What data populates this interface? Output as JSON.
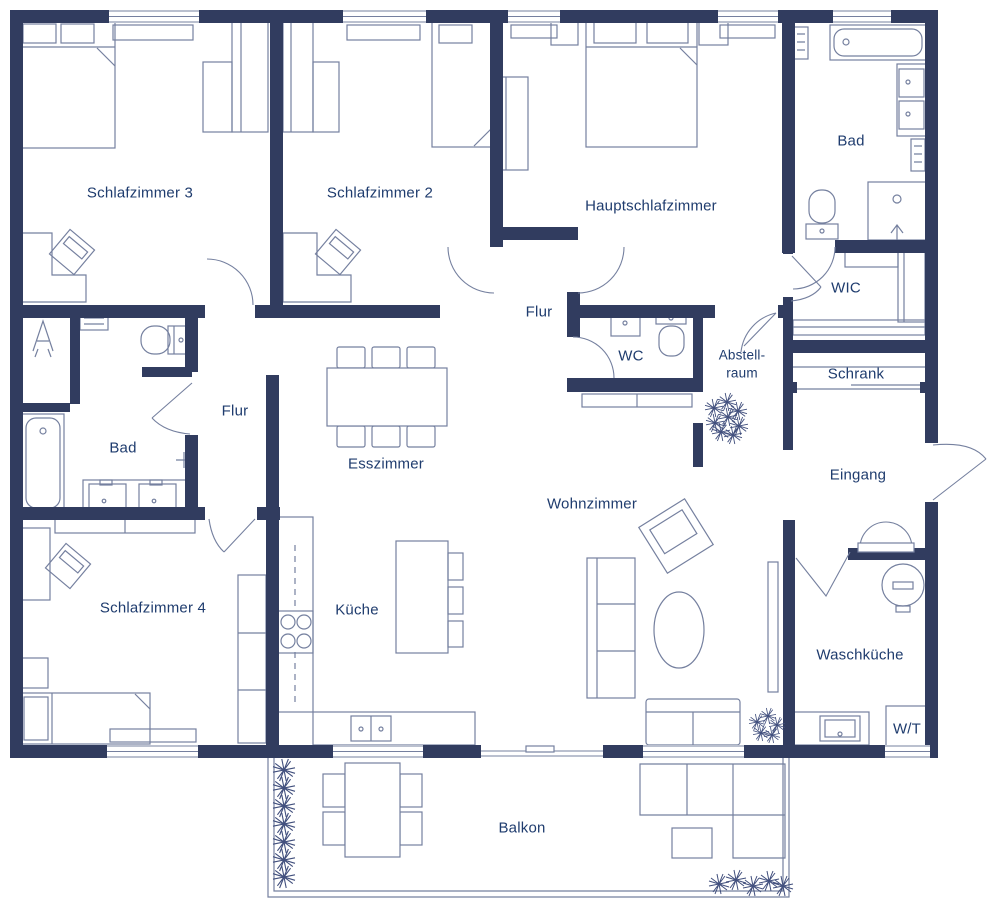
{
  "colors": {
    "wall": "#313c5f",
    "furniture_line": "#75809f",
    "text": "#1f3c6e",
    "plant": "#414f7d",
    "background": "#ffffff"
  },
  "rooms": {
    "schlafzimmer3": {
      "label": "Schlafzimmer 3"
    },
    "schlafzimmer2": {
      "label": "Schlafzimmer 2"
    },
    "hauptschlafzimmer": {
      "label": "Hauptschlafzimmer"
    },
    "bad_oben": {
      "label": "Bad"
    },
    "wic": {
      "label": "WIC"
    },
    "flur_mitte": {
      "label": "Flur"
    },
    "wc": {
      "label": "WC"
    },
    "abstellraum": {
      "label": "Abstell-\nraum"
    },
    "schrank": {
      "label": "Schrank"
    },
    "eingang": {
      "label": "Eingang"
    },
    "flur_links": {
      "label": "Flur"
    },
    "bad_links": {
      "label": "Bad"
    },
    "esszimmer": {
      "label": "Esszimmer"
    },
    "wohnzimmer": {
      "label": "Wohnzimmer"
    },
    "schlafzimmer4": {
      "label": "Schlafzimmer 4"
    },
    "kueche": {
      "label": "Küche"
    },
    "waschtrockner": {
      "label": "W/T"
    },
    "waschkueche": {
      "label": "Waschküche"
    },
    "balkon": {
      "label": "Balkon"
    }
  }
}
